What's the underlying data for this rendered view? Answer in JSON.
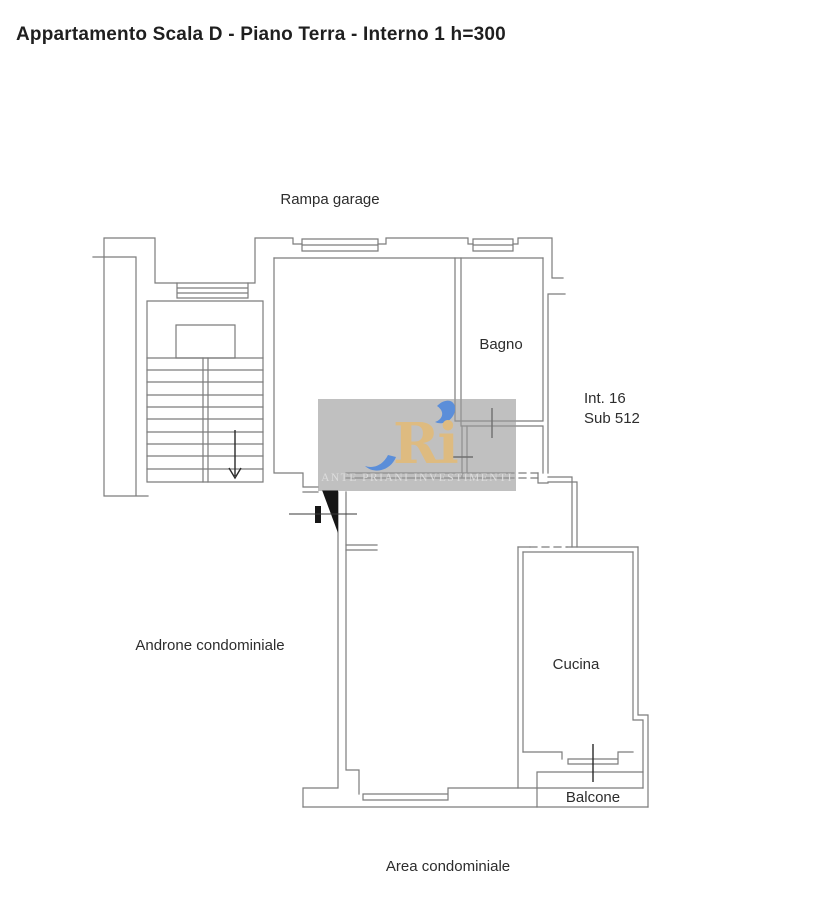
{
  "header": {
    "title": "Appartamento Scala D - Piano Terra - Interno 1 h=300"
  },
  "plan": {
    "labels": {
      "rampa_garage": "Rampa garage",
      "bagno": "Bagno",
      "interno": "Int. 16",
      "sub": "Sub 512",
      "androne": "Androne condominiale",
      "cucina": "Cucina",
      "balcone": "Balcone",
      "area_condominiale": "Area condominiale"
    }
  },
  "watermark": {
    "logo_text": "Ri",
    "company_name": "Ante Priani Investimenti"
  },
  "colors": {
    "wall_gray": "#7c7c7c",
    "tick_dark": "#2a2a2a",
    "text_dark": "#2d2d2d",
    "watermark_bg": "#9a9a9a",
    "logo_gold": "#debb80",
    "logo_blue": "#5b8ed9",
    "watermark_text": "#dcdcdc"
  }
}
